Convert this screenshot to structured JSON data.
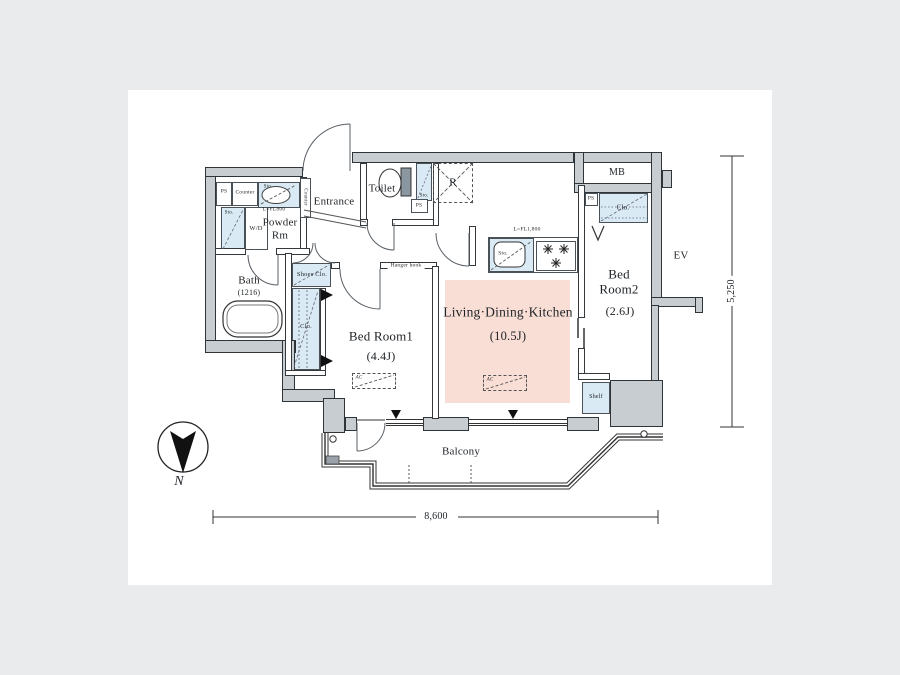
{
  "rooms": {
    "entrance": "Entrance",
    "toilet": "Toilet",
    "powder_line1": "Powder",
    "powder_line2": "Rm",
    "bath": "Bath",
    "bath_size": "(1216)",
    "bed1": "Bed Room1",
    "bed1_size": "(4.4J)",
    "ldk": "Living·Dining·Kitchen",
    "ldk_size": "(10.5J)",
    "bed2_line1": "Bed",
    "bed2_line2": "Room2",
    "bed2_size": "(2.6J)",
    "balcony": "Balcony"
  },
  "fixtures": {
    "mb": "MB",
    "ev": "EV",
    "shelf": "Shelf",
    "shoes_closet": "Shoes Clo.",
    "closet": "Clo.",
    "hanger_hook": "Hanger hook",
    "washer_dryer": "W/D",
    "counter": "Counter",
    "fridge": "R",
    "ac": "AC",
    "ps": "PS",
    "storage": "Sto."
  },
  "annotations": {
    "powder_counter_length": "L=FL800",
    "kitchen_counter_length": "L=FL1,800"
  },
  "dimensions": {
    "width": "8,600",
    "depth": "5,250"
  },
  "compass": {
    "north": "N"
  },
  "colors": {
    "wall_fill": "#c8cdd2",
    "outline": "#2f3439",
    "closet_blue": "#d9eaf4",
    "ldk_pink": "#f9ded6",
    "background": "#e9ebed"
  }
}
